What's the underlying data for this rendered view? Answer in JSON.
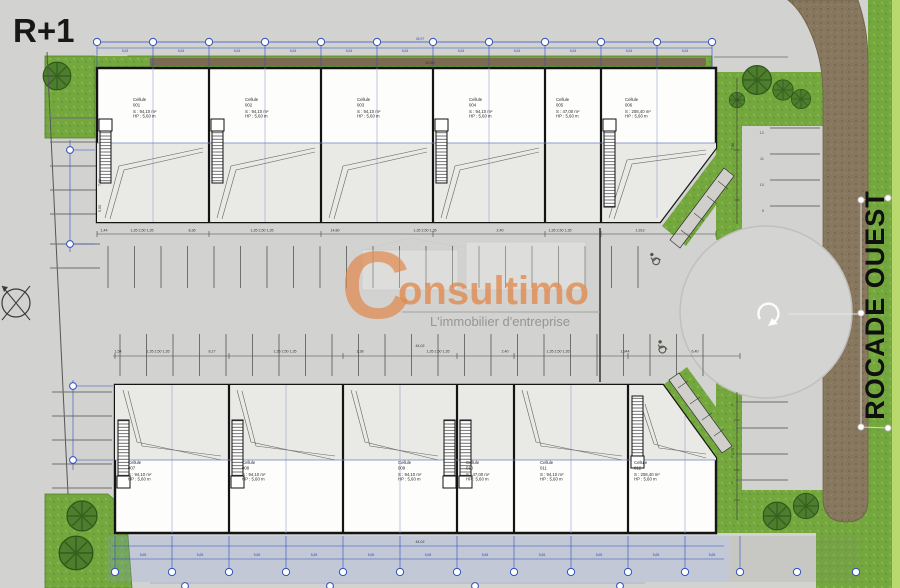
{
  "labels": {
    "floor": "R+1",
    "road": "ROCADE OUEST",
    "cellule": "Cellule"
  },
  "watermark": {
    "initial": "C",
    "rest": "onsultimo",
    "tagline": "L'immobilier d'entreprise"
  },
  "buildings": {
    "top": {
      "cells": [
        {
          "num": "001",
          "area": "S : 94,10 m²",
          "hp": "HP : 5,60 m"
        },
        {
          "num": "002",
          "area": "S : 94,10 m²",
          "hp": "HP : 5,60 m"
        },
        {
          "num": "003",
          "area": "S : 94,10 m²",
          "hp": "HP : 5,60 m"
        },
        {
          "num": "004",
          "area": "S : 94,10 m²",
          "hp": "HP : 5,60 m"
        },
        {
          "num": "005",
          "area": "S : 47,00 m²",
          "hp": "HP : 5,60 m"
        },
        {
          "num": "006",
          "area": "S : 208,40 m²",
          "hp": "HP : 5,60 m"
        }
      ]
    },
    "bottom": {
      "cells": [
        {
          "num": "007",
          "area": "S : 94,10 m²",
          "hp": "HP : 5,60 m"
        },
        {
          "num": "008",
          "area": "S : 94,10 m²",
          "hp": "HP : 5,60 m"
        },
        {
          "num": "009",
          "area": "S : 94,10 m²",
          "hp": "HP : 5,60 m"
        },
        {
          "num": "010",
          "area": "S : 47,00 m²",
          "hp": "HP : 5,60 m"
        },
        {
          "num": "011",
          "area": "S : 94,10 m²",
          "hp": "HP : 5,60 m"
        },
        {
          "num": "012",
          "area": "S : 208,40 m²",
          "hp": "HP : 5,60 m"
        }
      ]
    }
  },
  "dims": {
    "top_total": "45,97",
    "top_inner": "43,60",
    "bay_top": "5,63",
    "bay_bottom": "5,65",
    "bottom_total": "44,02",
    "mid_lower_total": "44,02",
    "left_v1": "7,88",
    "left_v2": "5,00",
    "right_v1": "7,98",
    "right_v2": "4,70",
    "mid_upper": [
      "1,44",
      "1,35 2,50 1,35",
      "8,36",
      "1,35 2,50 1,35",
      "14,80",
      "1,35 2,50 1,35",
      "2,40",
      "1,35 2,50 1,35",
      "1,913"
    ],
    "mid_lower": [
      "1,54",
      "1,35 2,50 1,35",
      "8,17",
      "1,35 2,50 1,35",
      "1,38",
      "1,35 2,50 1,35",
      "2,40",
      "1,35 2,50 1,35",
      "1,944",
      "6,40"
    ]
  },
  "parking": {
    "right_top": [
      "12",
      "11",
      "10",
      "9"
    ],
    "right_bottom": [
      "8",
      "7",
      "6",
      "5"
    ]
  },
  "colors": {
    "background": "#d2d2d0",
    "grass": "#74a83e",
    "road": "#87775f",
    "dimension_blue": "#2d4fc0",
    "watermark_orange": "#e18a4e"
  }
}
